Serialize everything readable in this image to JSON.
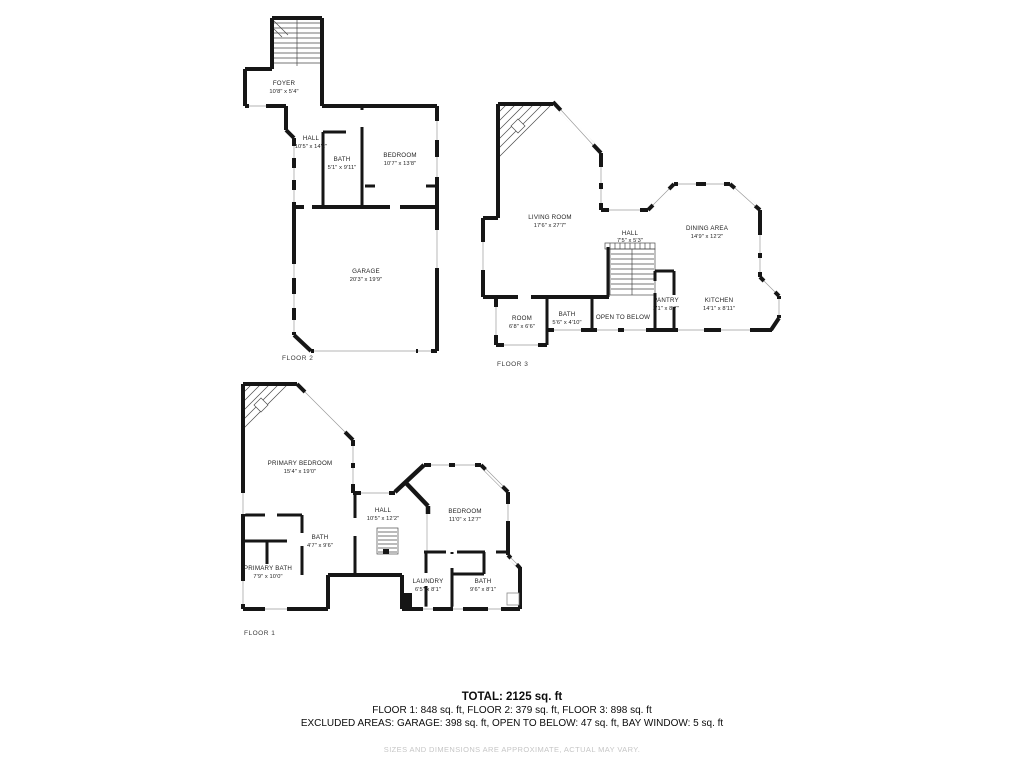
{
  "page": {
    "background": "#ffffff",
    "wall_color": "#161616"
  },
  "floors": {
    "floor2": {
      "caption": "FLOOR 2",
      "rooms": {
        "foyer": {
          "name": "FOYER",
          "dims": "10'8\" x 5'4\""
        },
        "hall": {
          "name": "HALL",
          "dims": "10'5\" x 14'2\""
        },
        "bath": {
          "name": "BATH",
          "dims": "5'1\" x 9'11\""
        },
        "bedroom": {
          "name": "BEDROOM",
          "dims": "10'7\" x 13'8\""
        },
        "garage": {
          "name": "GARAGE",
          "dims": "20'3\" x 19'9\""
        }
      }
    },
    "floor3": {
      "caption": "FLOOR 3",
      "rooms": {
        "living_room": {
          "name": "LIVING ROOM",
          "dims": "17'6\" x 27'7\""
        },
        "hall": {
          "name": "HALL",
          "dims": "7'5\" x 5'3\""
        },
        "dining_area": {
          "name": "DINING AREA",
          "dims": "14'9\" x 12'2\""
        },
        "kitchen": {
          "name": "KITCHEN",
          "dims": "14'1\" x 8'11\""
        },
        "pantry": {
          "name": "PANTRY",
          "dims": "2'1\" x 8'7\""
        },
        "room": {
          "name": "ROOM",
          "dims": "6'8\" x 6'6\""
        },
        "bath": {
          "name": "BATH",
          "dims": "5'6\" x 4'10\""
        },
        "open_to_below": {
          "name": "OPEN TO BELOW"
        }
      }
    },
    "floor1": {
      "caption": "FLOOR 1",
      "rooms": {
        "primary_bedroom": {
          "name": "PRIMARY BEDROOM",
          "dims": "15'4\" x 19'0\""
        },
        "hall": {
          "name": "HALL",
          "dims": "10'5\" x 12'2\""
        },
        "bedroom": {
          "name": "BEDROOM",
          "dims": "11'0\" x 12'7\""
        },
        "bath": {
          "name": "BATH",
          "dims": "4'7\" x 9'6\""
        },
        "primary_bath": {
          "name": "PRIMARY BATH",
          "dims": "7'9\" x 10'0\""
        },
        "laundry": {
          "name": "LAUNDRY",
          "dims": "6'5\" x 8'1\""
        },
        "bath2": {
          "name": "BATH",
          "dims": "9'6\" x 8'1\""
        }
      }
    }
  },
  "summary": {
    "total": "TOTAL: 2125 sq. ft",
    "floors": "FLOOR 1: 848 sq. ft, FLOOR 2: 379 sq. ft, FLOOR 3: 898 sq. ft",
    "excluded": "EXCLUDED AREAS: GARAGE: 398 sq. ft, OPEN TO BELOW: 47 sq. ft, BAY WINDOW: 5 sq. ft",
    "disclaimer": "SIZES AND DIMENSIONS ARE APPROXIMATE, ACTUAL MAY VARY."
  }
}
